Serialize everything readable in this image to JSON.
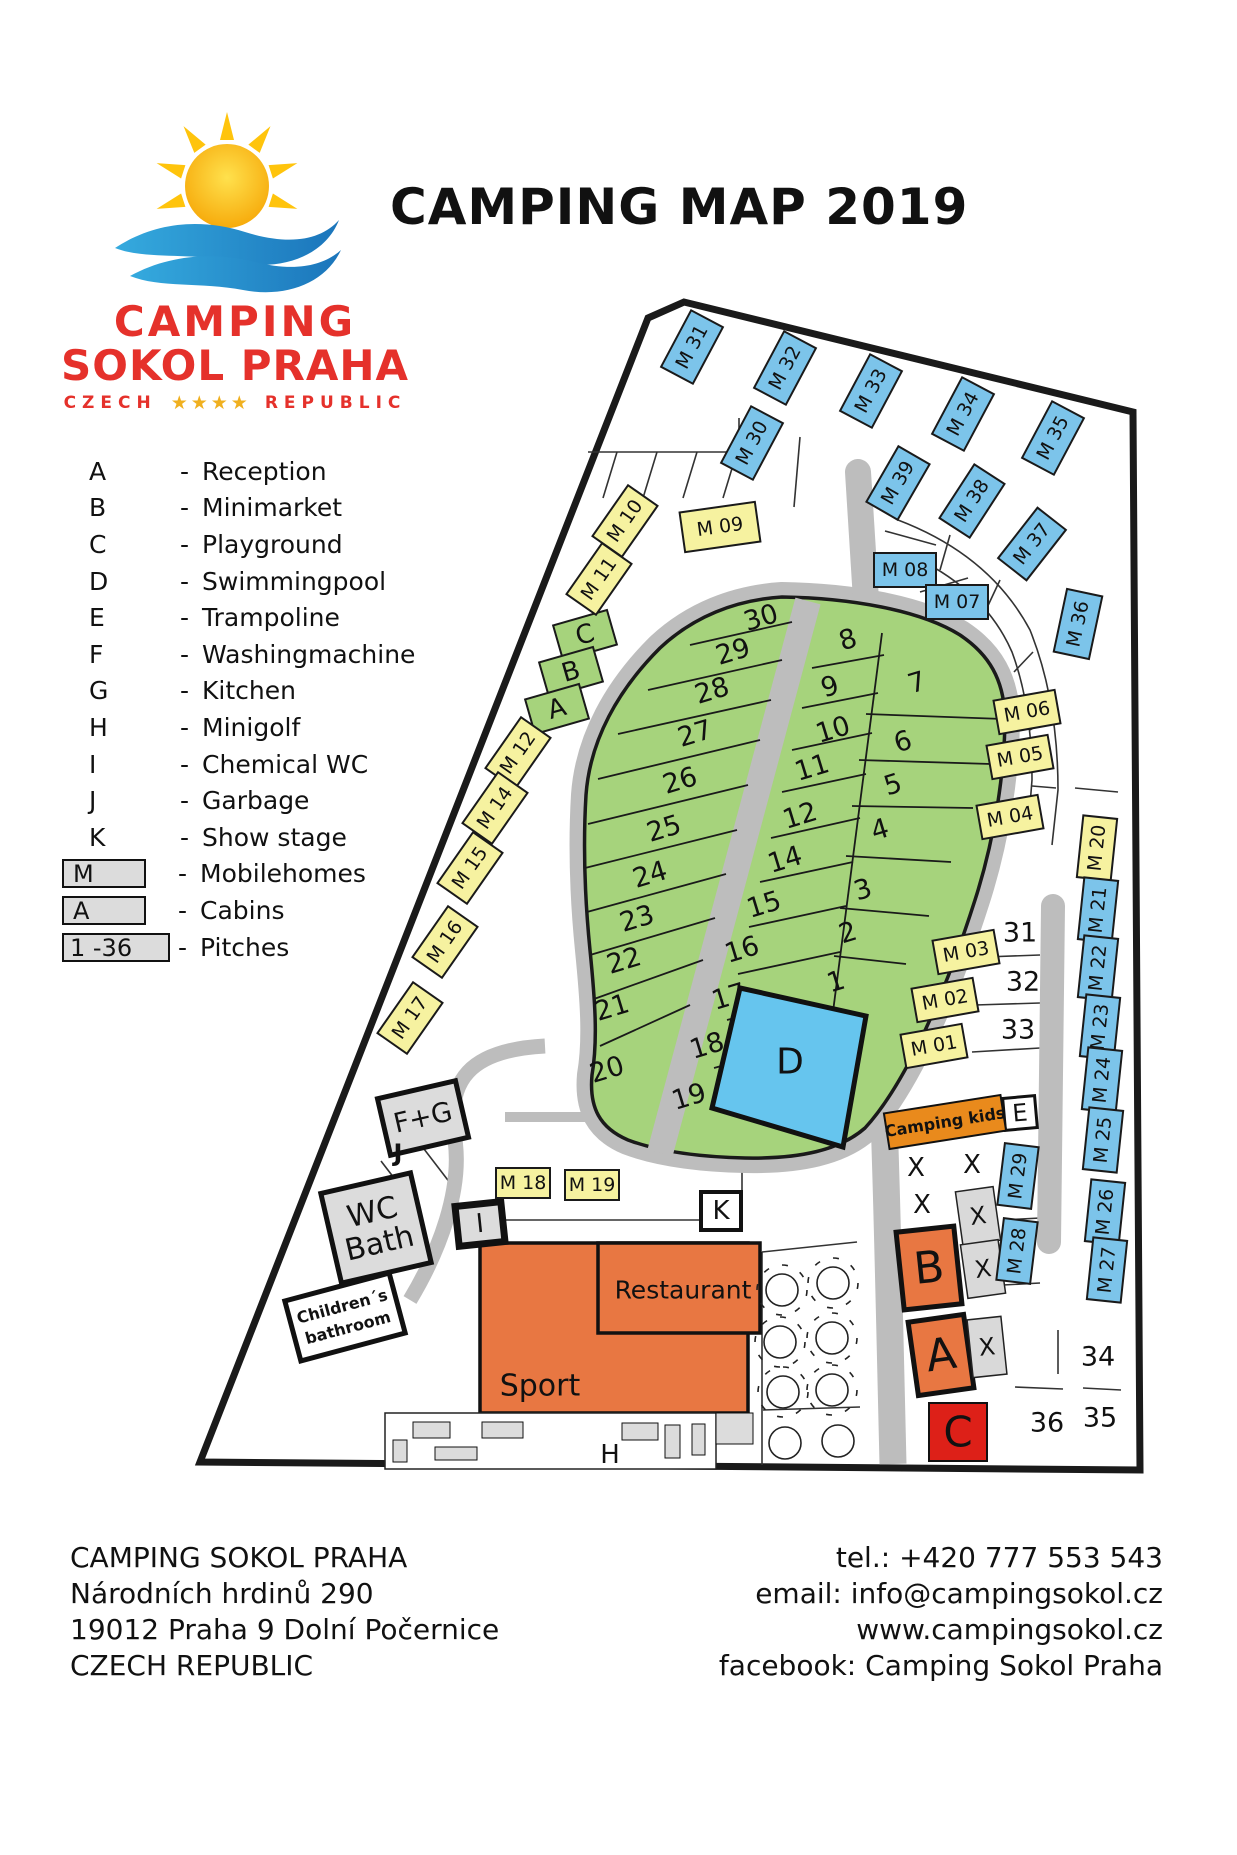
{
  "header": {
    "title": "CAMPING MAP 2019",
    "logo": {
      "line1": "CAMPING",
      "line2": "SOKOL PRAHA",
      "country_left": "CZECH",
      "stars": "★★★★",
      "country_right": "REPUBLIC"
    }
  },
  "legend": {
    "dash": "-",
    "items": [
      {
        "key": "A",
        "label": "Reception"
      },
      {
        "key": "B",
        "label": "Minimarket"
      },
      {
        "key": "C",
        "label": "Playground"
      },
      {
        "key": "D",
        "label": "Swimmingpool"
      },
      {
        "key": "E",
        "label": "Trampoline"
      },
      {
        "key": "F",
        "label": "Washingmachine"
      },
      {
        "key": "G",
        "label": "Kitchen"
      },
      {
        "key": "H",
        "label": "Minigolf"
      },
      {
        "key": "I",
        "label": "Chemical WC"
      },
      {
        "key": "J",
        "label": "Garbage"
      },
      {
        "key": "K",
        "label": "Show stage"
      }
    ],
    "box_items": [
      {
        "key": "M",
        "label": "Mobilehomes"
      },
      {
        "key": "A",
        "label": "Cabins"
      },
      {
        "key": "1 -36",
        "label": "Pitches"
      }
    ]
  },
  "map": {
    "mobile_homes": {
      "m01": "M 01",
      "m02": "M 02",
      "m03": "M 03",
      "m04": "M 04",
      "m05": "M 05",
      "m06": "M 06",
      "m07": "M 07",
      "m08": "M 08",
      "m09": "M 09",
      "m10": "M 10",
      "m11": "M 11",
      "m12": "M 12",
      "m14": "M 14",
      "m15": "M 15",
      "m16": "M 16",
      "m17": "M 17",
      "m18": "M 18",
      "m19": "M 19",
      "m20": "M 20",
      "m21": "M 21",
      "m22": "M 22",
      "m23": "M 23",
      "m24": "M 24",
      "m25": "M 25",
      "m26": "M 26",
      "m27": "M 27",
      "m28": "M 28",
      "m29": "M 29",
      "m30": "M 30",
      "m31": "M 31",
      "m32": "M 32",
      "m33": "M 33",
      "m34": "M 34",
      "m35": "M 35",
      "m36": "M 36",
      "m37": "M 37",
      "m38": "M 38",
      "m39": "M 39"
    },
    "pitch_labels": [
      "30",
      "29",
      "28",
      "27",
      "26",
      "25",
      "24",
      "23",
      "22",
      "21",
      "20",
      "8",
      "9",
      "10",
      "11",
      "12",
      "14",
      "15",
      "16",
      "17",
      "18",
      "19",
      "7",
      "6",
      "5",
      "4",
      "3",
      "2",
      "1",
      "31",
      "32",
      "33",
      "34",
      "35",
      "36"
    ],
    "facilities": {
      "a": "A",
      "b": "B",
      "c": "C",
      "d": "D",
      "e": "E",
      "fg": "F+G",
      "h": "H",
      "i": "I",
      "j": "J",
      "k": "K",
      "x": "X",
      "wc_line1": "WC",
      "wc_line2": "Bath",
      "child_line1": "Children´s",
      "child_line2": "bathroom",
      "kids": "Camping kids",
      "sport": "Sport",
      "restaurant": "Restaurant"
    }
  },
  "footer": {
    "left": [
      "CAMPING SOKOL PRAHA",
      "Národních hrdinů 290",
      "19012 Praha 9 Dolní Počernice",
      "CZECH REPUBLIC"
    ],
    "right": [
      "tel.: +420 777 553 543",
      "email: info@campingsokol.cz",
      "www.campingsokol.cz",
      "facebook: Camping Sokol Praha"
    ]
  },
  "colors": {
    "mobilehome_yellow": "#f6f2a0",
    "mobilehome_blue": "#7cc4ea",
    "pitch_green": "#a6d37c",
    "road_grey": "#bdbdbd",
    "building_orange": "#e87742",
    "pool_blue": "#66c5ee",
    "marker_red": "#dd2018",
    "kids_orange": "#e98a1c",
    "logo_red": "#e5312b",
    "star_gold": "#f0b01f",
    "facility_grey": "#dcdcdc"
  }
}
